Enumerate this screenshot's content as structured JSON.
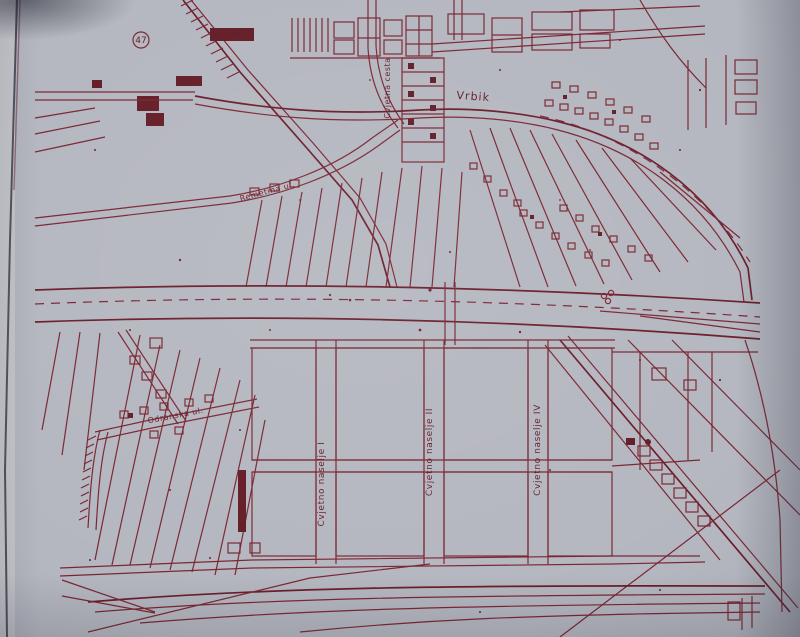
{
  "map": {
    "kind": "scanned cadastral city-plan photographed in a book",
    "ink_color": "#7a2531",
    "paper_color": "#b5b7c0",
    "labels": {
      "marker_47": "47",
      "vrbik": "Vrbik",
      "cvjetna_cesta": "Cvjetna cesta",
      "remetina_ul": "Remetina ul.",
      "odranska_ul": "Odranska ul.",
      "cvjetno_naselje_1": "Cvjetno naselje I",
      "cvjetno_naselje_2": "Cvjetno naselje II",
      "cvjetno_naselje_4": "Cvjetno naselje IV"
    },
    "symbols": {
      "circled_number_marker": "circle-with-number-47",
      "railway": "double-line-with-tick-hatching",
      "house": "small-square-footprint-with-inner-court",
      "dashed_line": "boundary-dashed-line"
    }
  }
}
